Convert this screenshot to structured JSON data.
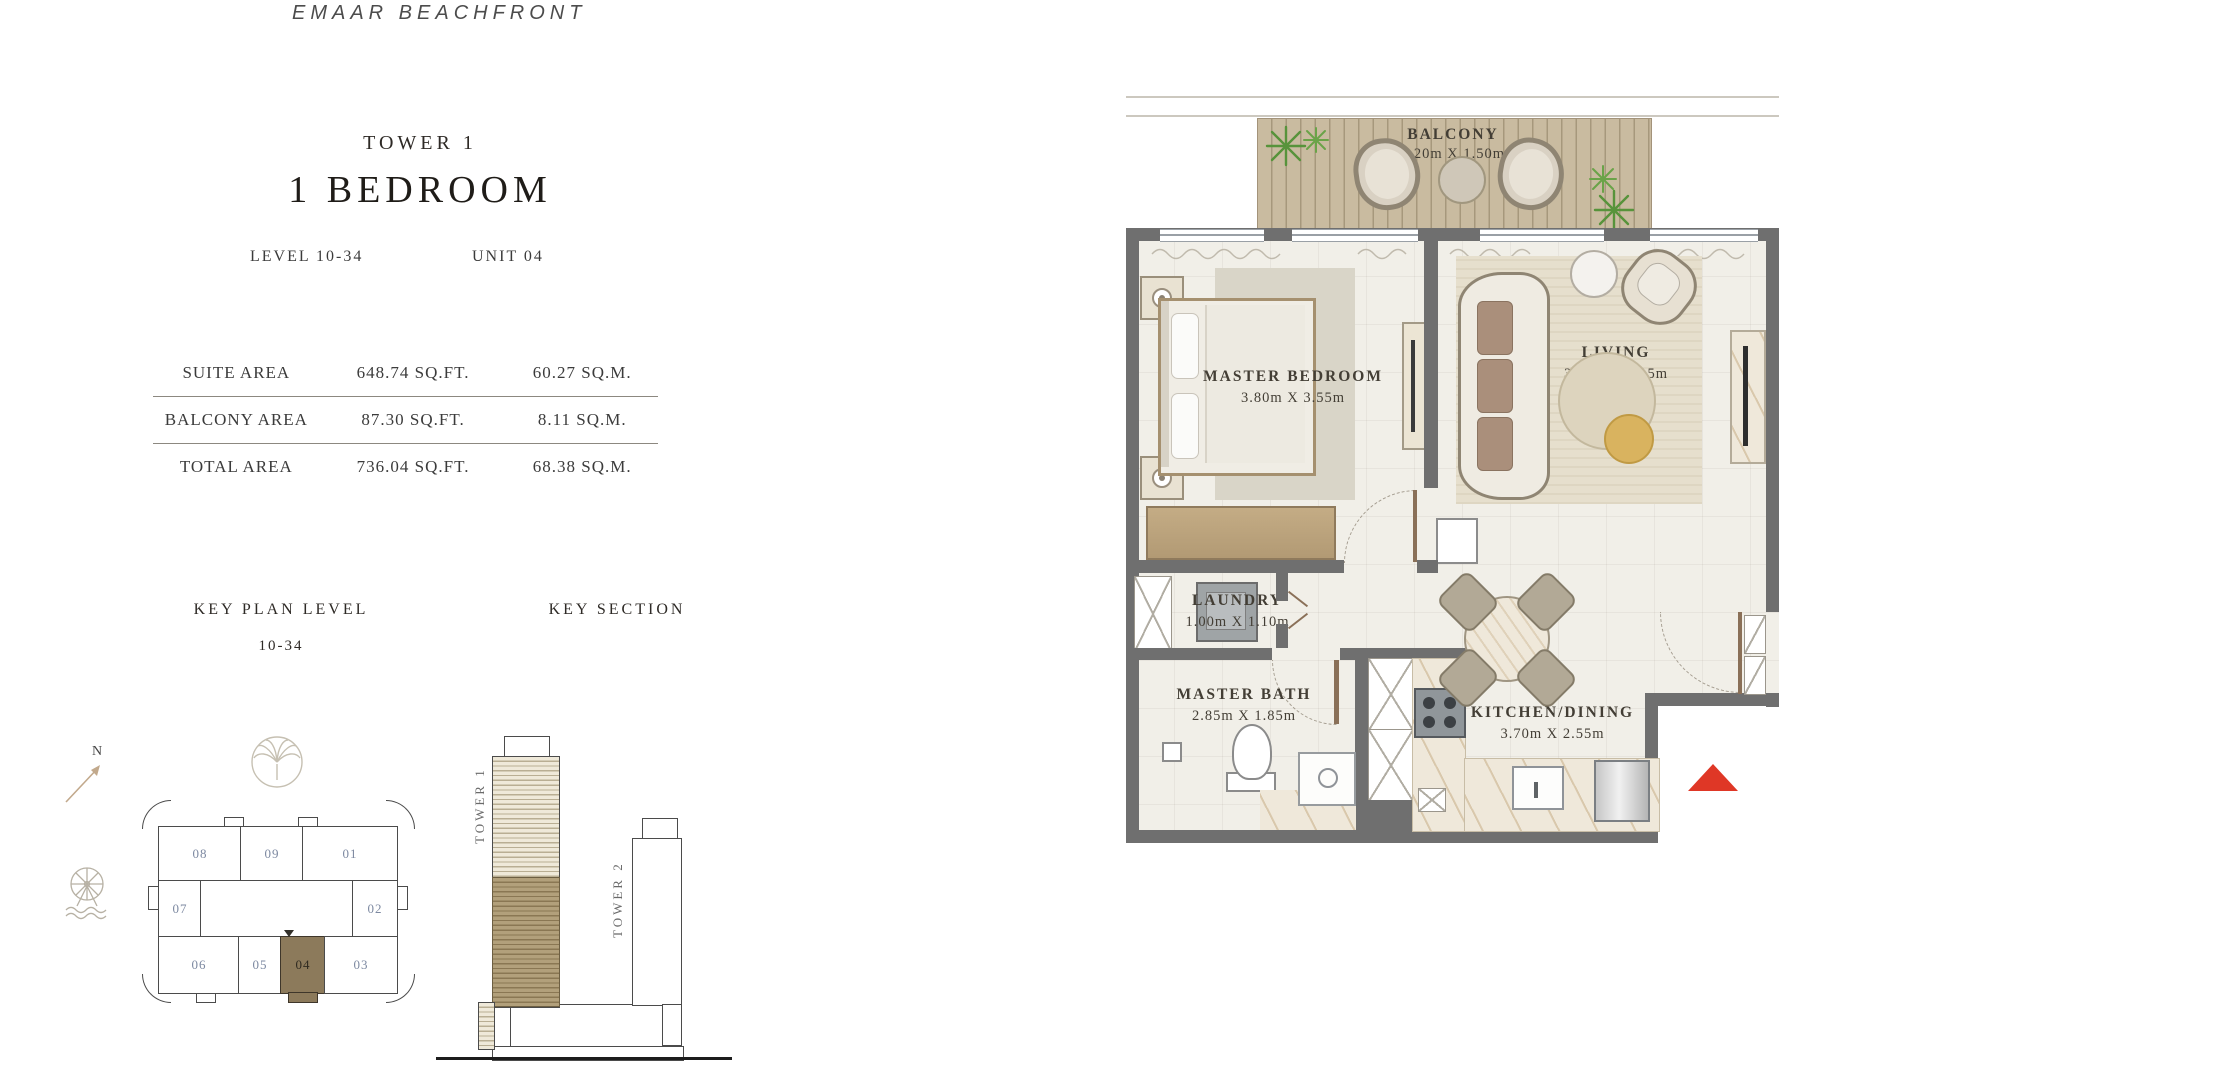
{
  "brand": {
    "title": "EMAAR  BEACHFRONT"
  },
  "header": {
    "tower": "TOWER 1",
    "unit_type": "1 BEDROOM",
    "level": "LEVEL 10-34",
    "unit": "UNIT 04"
  },
  "area_table": {
    "rows": [
      {
        "label": "SUITE AREA",
        "sqft": "648.74 SQ.FT.",
        "sqm": "60.27 SQ.M."
      },
      {
        "label": "BALCONY AREA",
        "sqft": "87.30 SQ.FT.",
        "sqm": "8.11 SQ.M."
      },
      {
        "label": "TOTAL AREA",
        "sqft": "736.04 SQ.FT.",
        "sqm": "68.38 SQ.M."
      }
    ]
  },
  "key_plan": {
    "title": "KEY PLAN LEVEL",
    "level_range": "10-34",
    "north_label": "N",
    "units": [
      "08",
      "09",
      "01",
      "07",
      "02",
      "06",
      "05",
      "04",
      "03"
    ],
    "highlighted_unit": "04"
  },
  "key_section": {
    "title": "KEY SECTION",
    "tower1_label": "TOWER 1",
    "tower2_label": "TOWER 2"
  },
  "floor_plan": {
    "rooms": {
      "balcony": {
        "name": "BALCONY",
        "dims": "5.20m X 1.50m"
      },
      "master_bedroom": {
        "name": "MASTER BEDROOM",
        "dims": "3.80m X 3.55m"
      },
      "living": {
        "name": "LIVING",
        "dims": "3.80m X 4.15m"
      },
      "laundry": {
        "name": "LAUNDRY",
        "dims": "1.00m X 1.10m"
      },
      "master_bath": {
        "name": "MASTER BATH",
        "dims": "2.85m X 1.85m"
      },
      "kitchen_dining": {
        "name": "KITCHEN/DINING",
        "dims": "3.70m X 2.55m"
      }
    },
    "colors": {
      "wall": "#6f6f6f",
      "deck": "#c9bba0",
      "highlight": "#8c7a5b",
      "entrance_marker": "#df3726"
    }
  }
}
